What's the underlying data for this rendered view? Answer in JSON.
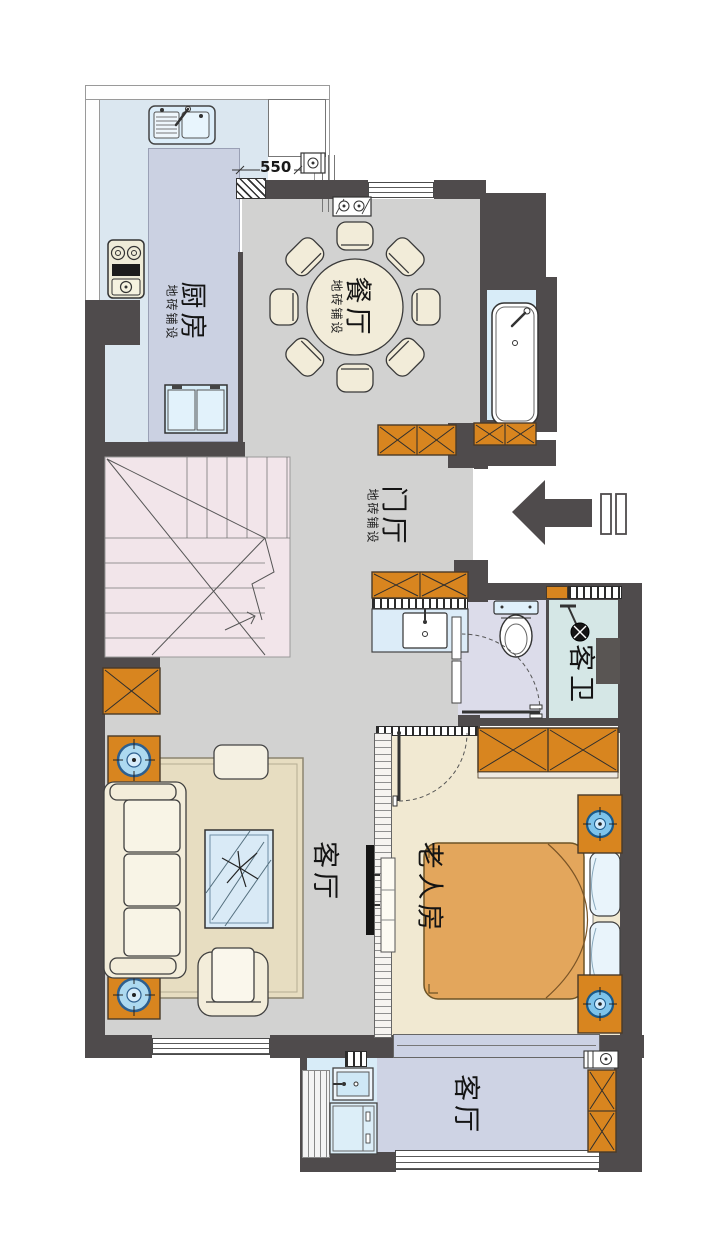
{
  "floorplan": {
    "dimension_label": "550",
    "rooms": {
      "kitchen": {
        "name": "厨房",
        "finish": "地砖铺设"
      },
      "dining": {
        "name": "餐厅",
        "finish": "地砖铺设"
      },
      "foyer": {
        "name": "门厅",
        "finish": "地砖铺设"
      },
      "living": {
        "name": "客厅"
      },
      "elder_bedroom": {
        "name": "老人房"
      },
      "guest_bath": {
        "name": "客卫"
      },
      "balcony": {
        "name": "客厅"
      }
    },
    "entrance": {
      "arrow_direction": "left"
    },
    "furniture": {
      "kitchen": [
        "sink",
        "gas-stove",
        "fridge",
        "island-counter"
      ],
      "dining": [
        "round-table-8-chairs",
        "flue"
      ],
      "bath_niche": [
        "bathtub"
      ],
      "guest_bath": [
        "toilet",
        "shower",
        "vanity-sink",
        "swing-door"
      ],
      "living": [
        "three-seat-sofa",
        "coffee-table",
        "armchair",
        "rug",
        "tv",
        "side-tables-with-plants",
        "console"
      ],
      "elder_bedroom": [
        "double-bed",
        "pillows",
        "nightstands-with-lamps",
        "wardrobe",
        "dresser",
        "swing-door"
      ],
      "balcony": [
        "laundry-sink",
        "washing-machine",
        "cabinet",
        "meters"
      ],
      "stairs": [
        "l-shaped-staircase"
      ]
    },
    "palette": {
      "wall": "#4f4b4c",
      "kitchen_floor": "#dbe7f0",
      "island": "#cbd1e2",
      "hall_floor": "#d2d2d1",
      "bedroom_floor": "#f1e9d2",
      "bath_blue": "#d8ecf8",
      "bath_teal": "#d5e7e6",
      "toilet_floor": "#dcdcea",
      "stair_pink": "#f2e5ea",
      "cabinet_orange": "#d8851f",
      "bed_orange": "#e3a65c",
      "rug": "#e7ddc1",
      "balcony_floor": "#ced3e4"
    }
  }
}
